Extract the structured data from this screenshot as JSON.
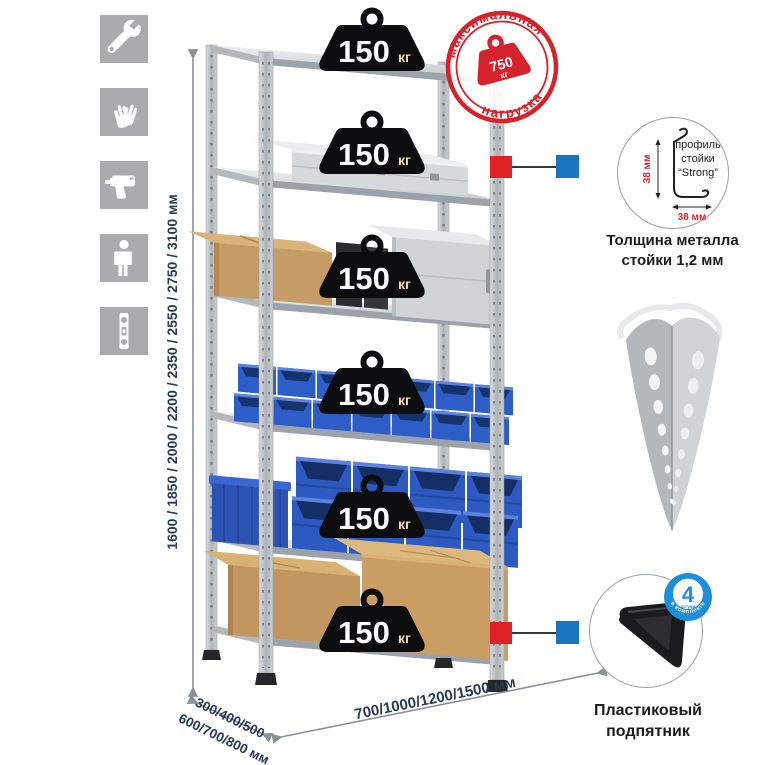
{
  "icons": [
    "wrench",
    "gloves",
    "drill",
    "person",
    "level"
  ],
  "load_badge": {
    "value": "150",
    "unit": "кг"
  },
  "stamp": {
    "top_text": "максимальная",
    "bottom_text": "нагрузка",
    "value": "750",
    "unit": "кг",
    "color": "#d6232b"
  },
  "dims": {
    "height": "1600 / 1850 / 2000 / 2200 / 2350 / 2550 / 2750 / 3100 мм",
    "width": "700/1000/1200/1500 мм",
    "depth1": "300/400/500",
    "depth2": "600/700/800 мм",
    "text_color": "#273a56"
  },
  "profile": {
    "dim_v": "38 мм",
    "dim_h": "38 мм",
    "l1": "профиль",
    "l2": "стойки",
    "l3": "“Strong”",
    "cap1": "Толщина металла",
    "cap2": "стойки 1,2 мм"
  },
  "foot": {
    "value": "4",
    "small": "штуки",
    "arc": "в комплекте",
    "cap1": "Пластиковый",
    "cap2": "подпятник",
    "badge_color": "#1d8ed8"
  },
  "callout": {
    "red": "#e02227",
    "blue": "#1b74c0"
  }
}
